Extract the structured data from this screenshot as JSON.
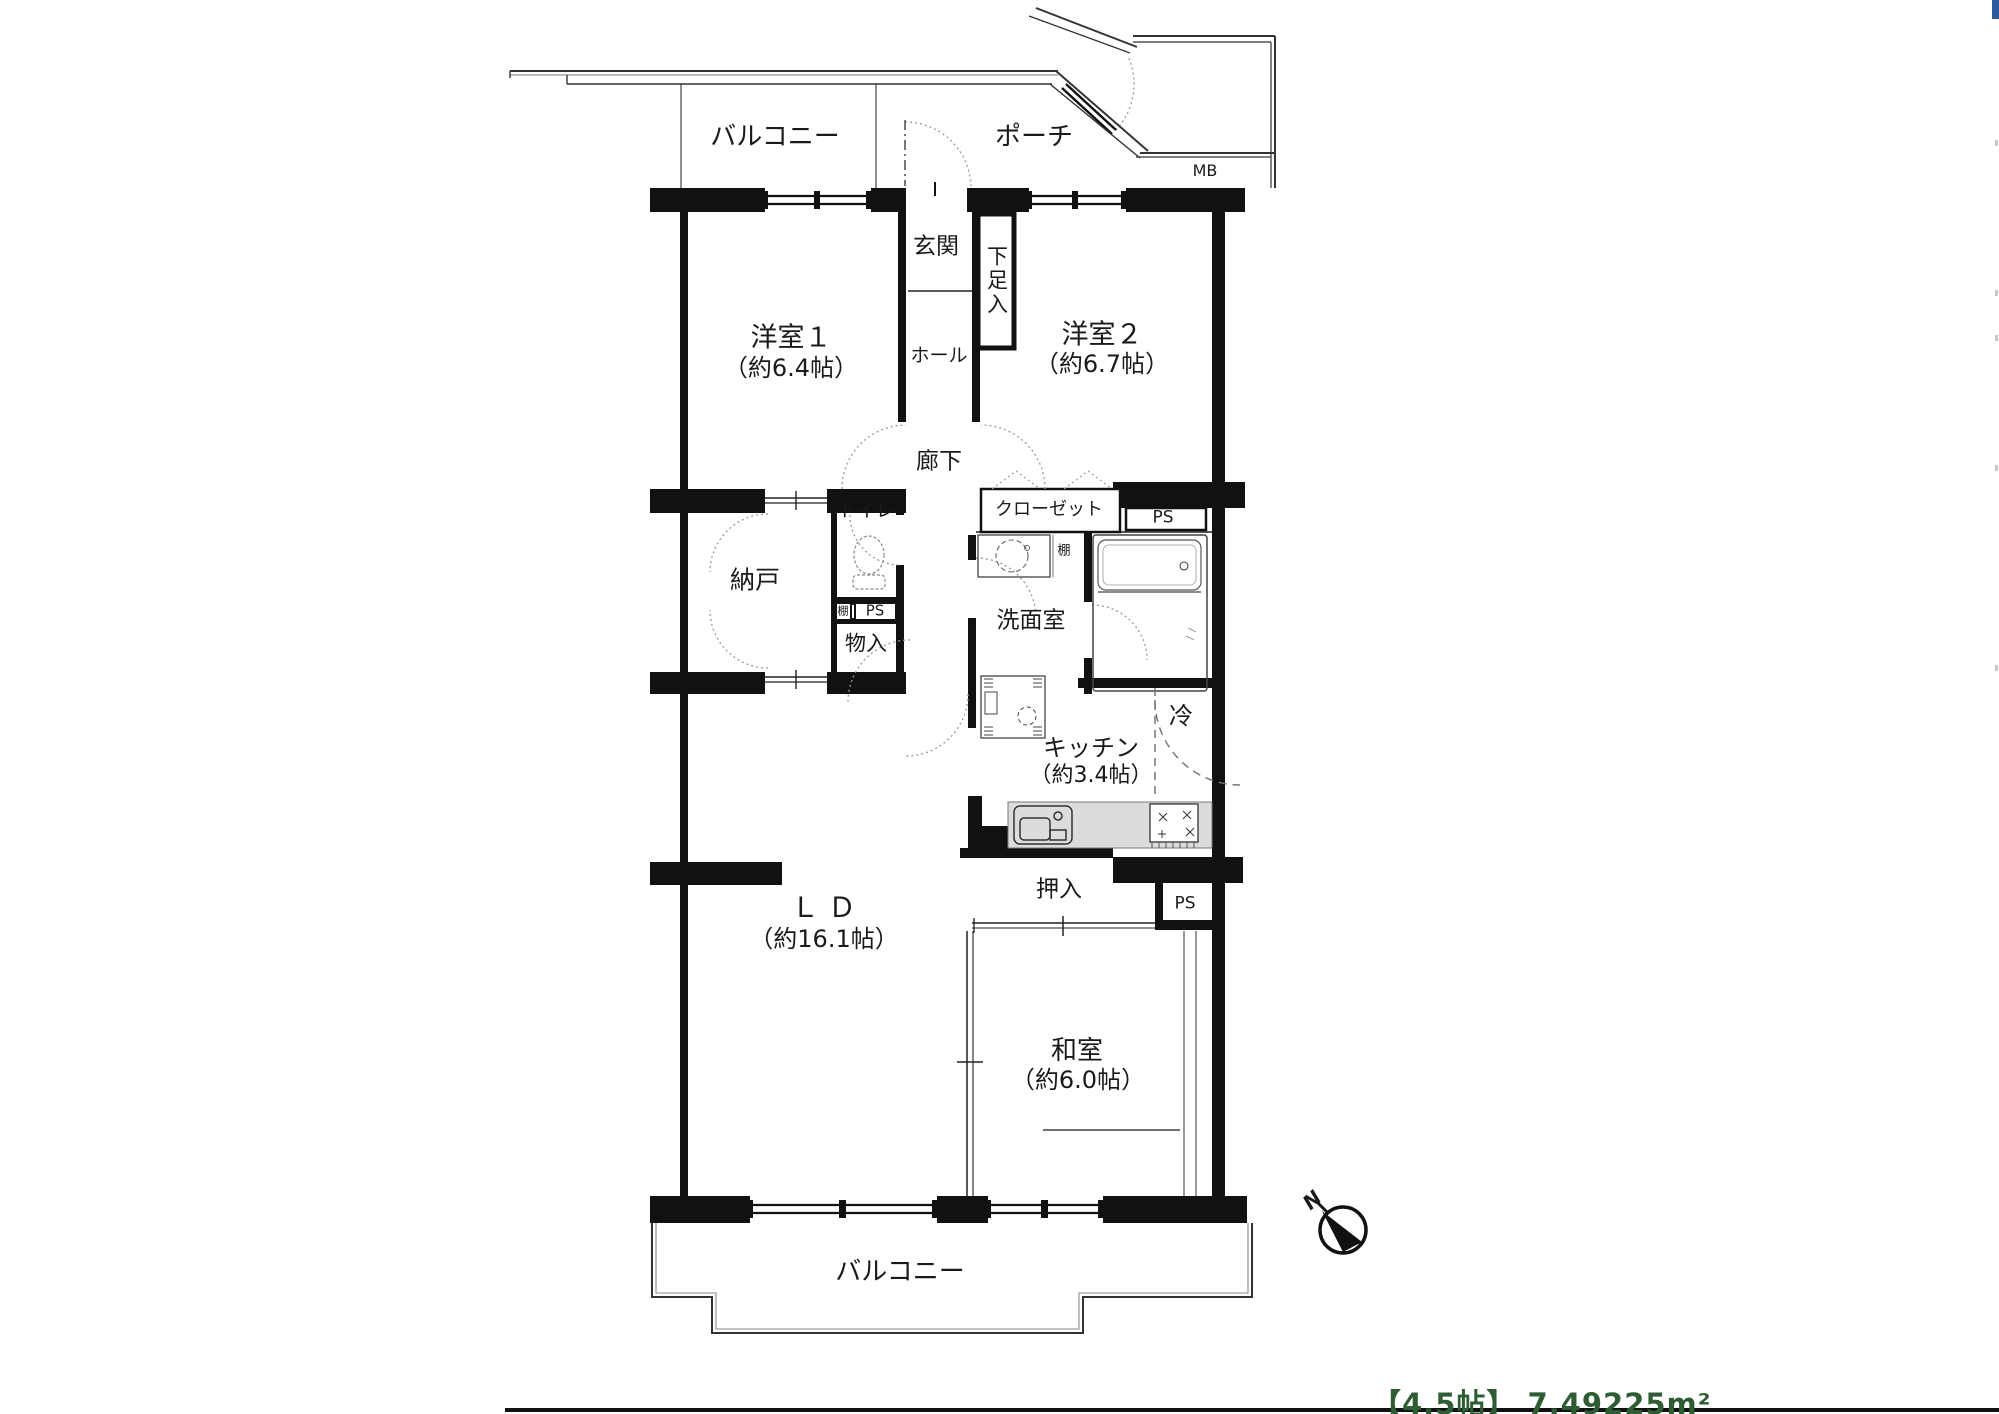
{
  "labels": {
    "balcony_top": "バルコニー",
    "porch": "ポーチ",
    "mb": "MB",
    "genkan": "玄関",
    "shoe_cupboard": "下足入",
    "hall": "ホール",
    "corridor": "廊下",
    "western1_name": "洋室１",
    "western1_size": "（約6.4帖）",
    "western2_name": "洋室２",
    "western2_size": "（約6.7帖）",
    "storage_room": "納戸",
    "toilet": "トイレ",
    "shelf_small": "棚",
    "ps_small": "PS",
    "storage_box": "物入",
    "closet": "クローゼット",
    "ps_right": "PS",
    "shelf_right": "棚",
    "washroom": "洗面室",
    "refrigerator": "冷",
    "kitchen_name": "キッチン",
    "kitchen_size": "（約3.4帖）",
    "oshiire": "押入",
    "ps_bottom": "PS",
    "ld_name": "ＬＤ",
    "ld_size": "（約16.1帖）",
    "japanese_room_name": "和室",
    "japanese_room_size": "（約6.0帖）",
    "balcony_bottom": "バルコニー",
    "compass_north": "N",
    "area_note": "【4.5帖】 7.49225m²"
  },
  "colors": {
    "wall": "#111111",
    "kitchen_counter": "#dcdcdc",
    "area_note_green": "#2e5c33",
    "corner_tab_blue": "#2a5b9e"
  }
}
